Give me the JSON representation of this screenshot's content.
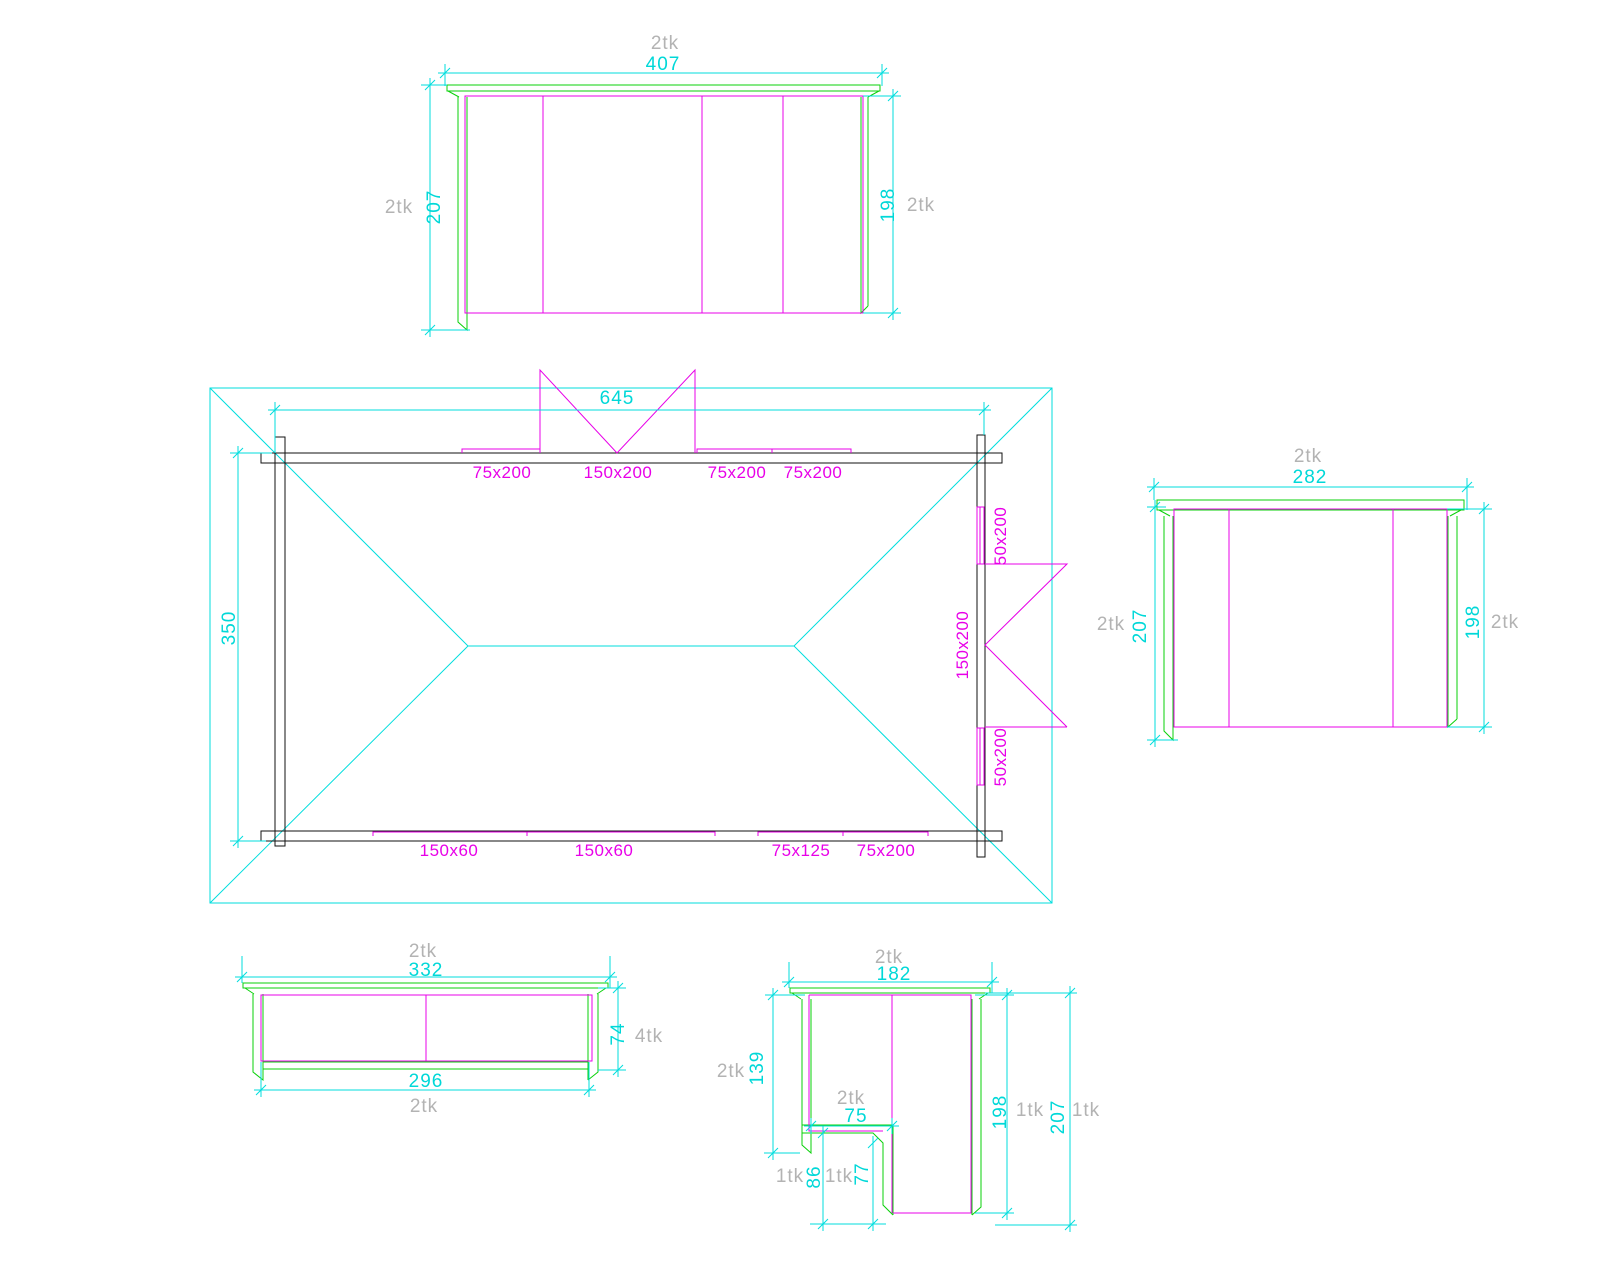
{
  "drawing": {
    "colors": {
      "dimension_cyan": "#00dede",
      "member_magenta": "#e800e8",
      "timber_green": "#0ad10a",
      "beam_black": "#121212",
      "quantity_gray": "#b3b3b3",
      "background": "#ffffff"
    },
    "plan": {
      "length": "645",
      "width": "350",
      "top_members": [
        "75x200",
        "150x200",
        "75x200",
        "75x200"
      ],
      "right_members": [
        "50x200",
        "150x200",
        "50x200"
      ],
      "bottom_members": [
        "150x60",
        "150x60",
        "75x125",
        "75x200"
      ]
    },
    "elevations": {
      "wall_407": {
        "qty": "2tk",
        "width": "407",
        "left_qty": "2tk",
        "left_height": "207",
        "right_height": "198",
        "right_qty": "2tk"
      },
      "wall_282": {
        "qty": "2tk",
        "width": "282",
        "left_qty": "2tk",
        "left_height": "207",
        "right_height": "198",
        "right_qty": "2tk"
      },
      "rail_332": {
        "qty": "2tk",
        "width": "332",
        "inner_width": "296",
        "inner_qty": "2tk",
        "height": "74",
        "height_qty": "4tk"
      },
      "corner_182": {
        "qty": "2tk",
        "width": "182",
        "left_qty": "2tk",
        "left_height": "139",
        "notch_qty": "2tk",
        "notch_width": "75",
        "foot1_qty": "1tk",
        "foot1_height": "86",
        "foot2_qty": "1tk",
        "foot2_height": "77",
        "inner_height": "198",
        "inner_qty": "1tk",
        "outer_height": "207",
        "outer_qty": "1tk"
      }
    }
  }
}
